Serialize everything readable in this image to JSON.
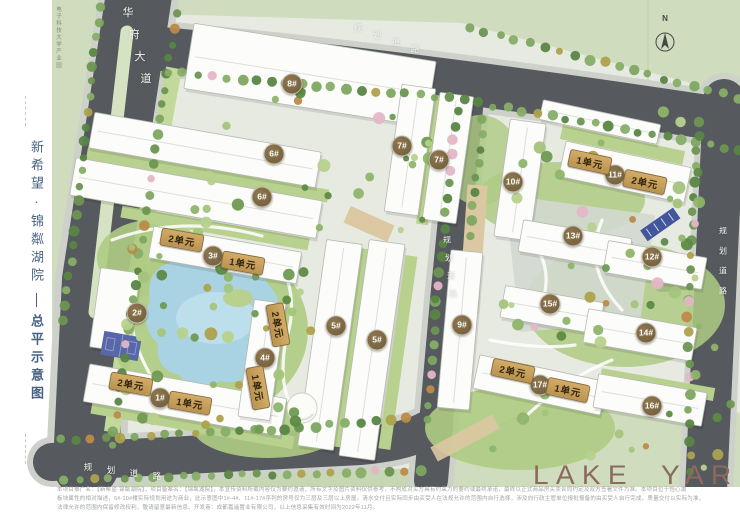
{
  "sidebar": {
    "project_name": "新希望·锦粼湖院",
    "drawing_title": "总平示意图"
  },
  "map": {
    "park_label": "电子科技大学产业园",
    "north_label": "N",
    "logo": "LAKE YARD",
    "road_labels": [
      {
        "text": "华府大道",
        "x": 128,
        "y": 12,
        "dx": 6,
        "dy": 22,
        "size": 11
      },
      {
        "text": "规划道路",
        "x": 358,
        "y": 28,
        "dx": 19,
        "dy": 7,
        "size": 8.5
      },
      {
        "text": "规划道路",
        "x": 447,
        "y": 240,
        "dx": 2,
        "dy": 18,
        "size": 8
      },
      {
        "text": "规划道路",
        "x": 723,
        "y": 231,
        "dx": 0,
        "dy": 20,
        "size": 8
      },
      {
        "text": "规划道路",
        "x": 88,
        "y": 467,
        "dx": 23,
        "dy": 3,
        "size": 8.5
      }
    ],
    "building_badges": [
      {
        "label": "8#",
        "x": 292,
        "y": 84
      },
      {
        "label": "6#",
        "x": 274,
        "y": 154
      },
      {
        "label": "6#",
        "x": 262,
        "y": 197
      },
      {
        "label": "7#",
        "x": 402,
        "y": 146
      },
      {
        "label": "7#",
        "x": 439,
        "y": 160
      },
      {
        "label": "3#",
        "x": 213,
        "y": 256
      },
      {
        "label": "2#",
        "x": 137,
        "y": 313
      },
      {
        "label": "4#",
        "x": 265,
        "y": 358
      },
      {
        "label": "1#",
        "x": 160,
        "y": 398
      },
      {
        "label": "5#",
        "x": 336,
        "y": 326
      },
      {
        "label": "5#",
        "x": 377,
        "y": 340
      },
      {
        "label": "9#",
        "x": 462,
        "y": 325
      },
      {
        "label": "10#",
        "x": 513,
        "y": 182
      },
      {
        "label": "11#",
        "x": 615,
        "y": 175
      },
      {
        "label": "13#",
        "x": 573,
        "y": 236
      },
      {
        "label": "12#",
        "x": 652,
        "y": 257
      },
      {
        "label": "15#",
        "x": 550,
        "y": 304
      },
      {
        "label": "14#",
        "x": 646,
        "y": 333
      },
      {
        "label": "17#",
        "x": 540,
        "y": 385
      },
      {
        "label": "16#",
        "x": 652,
        "y": 406
      }
    ],
    "unit_pills": [
      {
        "label": "2单元",
        "x": 182,
        "y": 240,
        "rot": 10
      },
      {
        "label": "1单元",
        "x": 243,
        "y": 263,
        "rot": 10
      },
      {
        "label": "2单元",
        "x": 131,
        "y": 384,
        "rot": 10
      },
      {
        "label": "1单元",
        "x": 190,
        "y": 403,
        "rot": 10
      },
      {
        "label": "2单元",
        "x": 278,
        "y": 325,
        "rot": 80
      },
      {
        "label": "1单元",
        "x": 258,
        "y": 388,
        "rot": 80
      },
      {
        "label": "1单元",
        "x": 590,
        "y": 162,
        "rot": 12
      },
      {
        "label": "2单元",
        "x": 645,
        "y": 182,
        "rot": 12
      },
      {
        "label": "2单元",
        "x": 513,
        "y": 371,
        "rot": 12
      },
      {
        "label": "1单元",
        "x": 568,
        "y": 390,
        "rot": 12
      }
    ],
    "colors": {
      "road": "#56595d",
      "out_green": "#cfdcbd",
      "site_ground": "#e7eae1",
      "lake": "#a9d2e3",
      "badge": "#7d6845",
      "pill": "#c8a15c",
      "logo": "#8c6a5e",
      "sidebar_text": "#4a6282"
    }
  },
  "footer": {
    "lines": [
      "本项目推广名：【新希望·锦粼湖院】，项目备案名：【锦粼湖院】，本宣传资料所载内容仅为要约邀请，所有文字及图片资料仅供参考，不构成对买方具有约束力的要约或最终承诺，最终以正式商品房买卖合同约定及双方签署文件为准。本项目位于怡心湖",
      "板块属性的相对描述，6#-10#楼实际规划用途为商业，此示意图中1#-4#、11#-17#序列的房号仅为三层及三层以上房屋。清水交付且实际同步由买受人在法规允许的范围内自行选择，涉及向行政主管单位报批报备的由买受人自行完成，质量交付以实际为准，",
      "法律允许的范围内保留修改权利，敬请留意最新信息。开发商：成都嘉遥置业有限公司，以上信息采集有效时间为2022年11月。"
    ]
  }
}
